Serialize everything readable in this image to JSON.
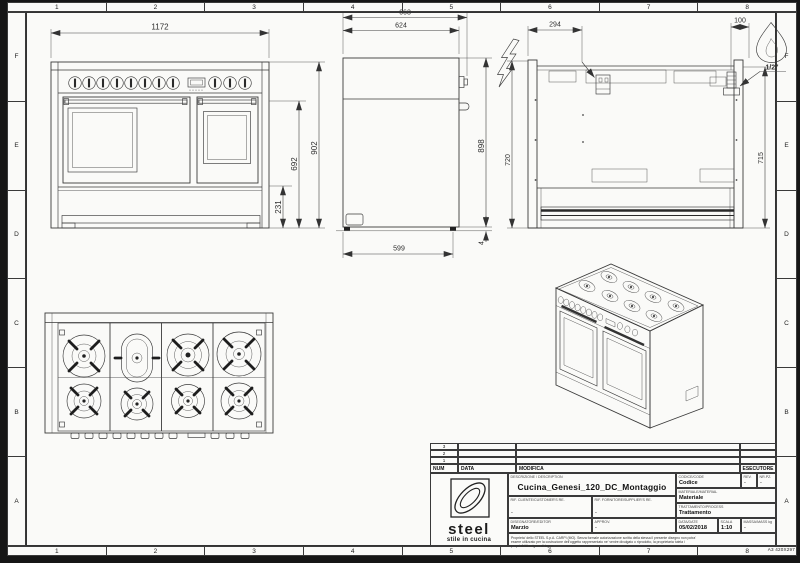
{
  "sheet": {
    "columns": [
      "1",
      "2",
      "3",
      "4",
      "5",
      "6",
      "7",
      "8"
    ],
    "rows": [
      "F",
      "E",
      "D",
      "C",
      "B",
      "A"
    ],
    "format_label": "A3 420X297"
  },
  "dims": {
    "front_width": "1172",
    "front_total_height": "902",
    "front_body_height": "692",
    "front_base_height": "231",
    "side_total_depth": "663",
    "side_body_depth": "624",
    "side_height": "898",
    "side_base_depth": "599",
    "side_foot_gap": "4",
    "back_electric_offset": "294",
    "back_gas_offset": "100",
    "back_left_height": "720",
    "back_right_height": "715",
    "gas_connection": "1/2\""
  },
  "symbols": {
    "electric": "lightning-bolt-icon",
    "gas": "flame-icon"
  },
  "title_block": {
    "rev_rows": [
      "3",
      "2",
      "1"
    ],
    "headers": {
      "num": "NUM",
      "date": "DATA",
      "modification": "MODIFICA",
      "executor": "ESECUTORE"
    },
    "labels": {
      "description": "DESCRIZIONE / DESCRIPTION",
      "code": "CODICE/CODE",
      "rev": "REV.",
      "nr_pz": "NR.PZ.",
      "material": "MATERIALE/MATERIAL",
      "customer_ref": "RIF. CLIENTE/CUSTOMER'S RE.",
      "supplier_ref": "RIF. FORNITORE/SUPPLIER'S RE.",
      "process": "TRATTAMENTO/PROCESS",
      "editor": "DISEGNATORE/EDITOR",
      "approved": "APPROV.",
      "date": "DATA/DATE",
      "scale": "SCALA",
      "mass": "MASSA/MASS kg"
    },
    "values": {
      "description": "Cucina_Genesi_120_DC_Montaggio",
      "code": "Codice",
      "rev": "-",
      "nr_pz": "-",
      "material": "Materiale",
      "customer_ref": "-",
      "supplier_ref": "-",
      "process": "Trattamento",
      "editor": "Marzio",
      "approved": "-",
      "date": "05/02/2018",
      "scale": "1:10",
      "mass": "-"
    },
    "logo": {
      "name": "steel",
      "tagline": "stile in cucina"
    },
    "disclaimer_lines": [
      "Proprieta' dello STEEL S.p.A. CARPI (MO). Senza formale autorizzazione scritta della stessa il presente disegno non potra'",
      "essere utilizzato per la costruzione dell'oggetto rappresentato ne' venire divulgato o riprodotto, la proprietaria tutela i",
      "propri diritti a rigore di legge."
    ]
  }
}
